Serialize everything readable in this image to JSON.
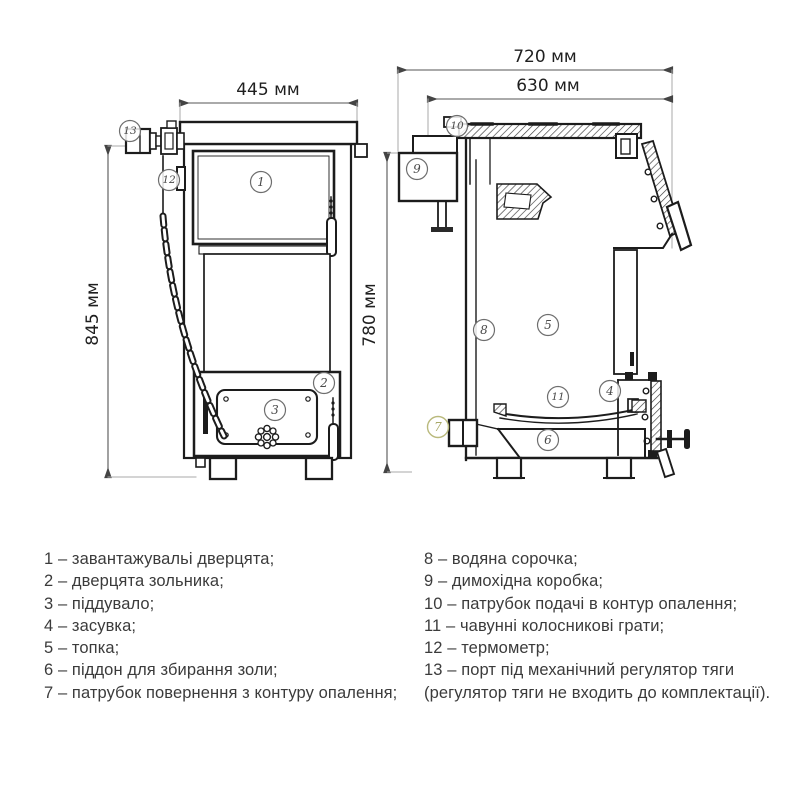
{
  "page": {
    "background": "#ffffff"
  },
  "diagram": {
    "dimensions": {
      "front_width": "445 мм",
      "front_height": "845 мм",
      "side_height": "780 мм",
      "side_outer_width": "720 мм",
      "side_inner_width": "630 мм"
    },
    "callouts": {
      "n1": "1",
      "n2": "2",
      "n3": "3",
      "n4": "4",
      "n5": "5",
      "n6": "6",
      "n7": "7",
      "n8": "8",
      "n9": "9",
      "n10": "10",
      "n11": "11",
      "n12": "12",
      "n13": "13"
    },
    "colors": {
      "line": "#1c1c1c",
      "dim_line": "#555555",
      "extension_line": "#aaaaaa",
      "callout_stroke": "#6e6e6e",
      "callout7_accent": "#b9b97c",
      "text": "#1f1f1f"
    }
  },
  "legend": {
    "left": [
      "1 – завантажувальі дверцята;",
      "2 – дверцята зольника;",
      "3 – піддувало;",
      "4 – засувка;",
      "5 – топка;",
      "6 – піддон для збирання золи;",
      "7 – патрубок повернення з контуру опалення;"
    ],
    "right": [
      "8 – водяна сорочка;",
      "9 – димохідна коробка;",
      "10 – патрубок подачі в контур опалення;",
      "11 – чавунні колосникові грати;",
      "12 – термометр;",
      "13 – порт під механічний регулятор тяги",
      "(регулятор тяги не входить до комплектації)."
    ]
  }
}
